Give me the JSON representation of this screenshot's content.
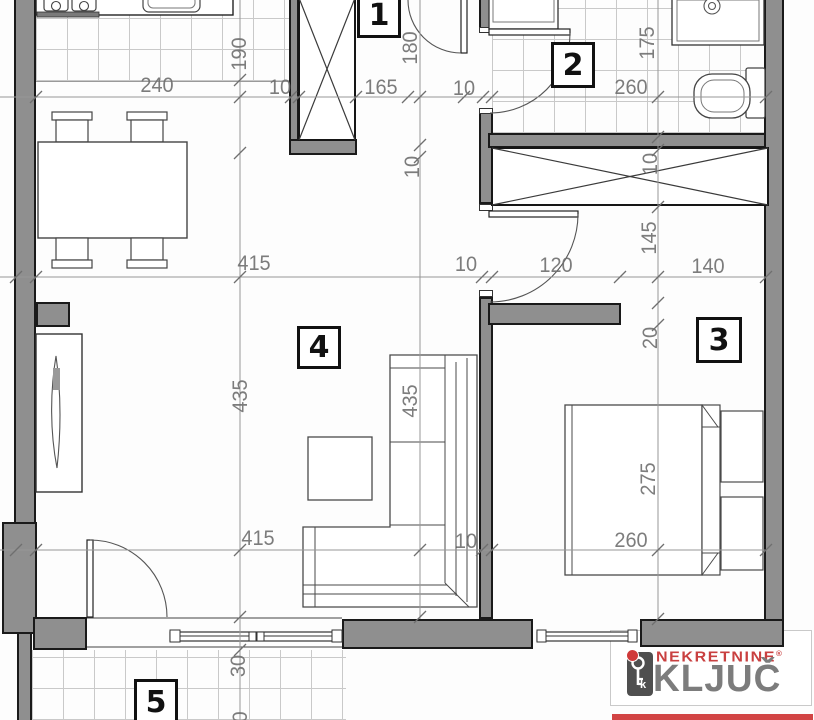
{
  "rooms": {
    "r1": "1",
    "r2": "2",
    "r3": "3",
    "r4": "4",
    "r5": "5"
  },
  "dims": {
    "top": {
      "a": "240",
      "b": "10",
      "c": "165",
      "d": "10",
      "e": "260"
    },
    "mid": {
      "a": "415",
      "b": "10",
      "c": "120",
      "d": "140"
    },
    "bottom": {
      "a": "415",
      "b": "10",
      "c": "260"
    },
    "col_left": {
      "a": "190",
      "b": "435",
      "c": "30",
      "d": "0"
    },
    "col_center": {
      "a": "180",
      "b": "10",
      "c": "435"
    },
    "col_right": {
      "a": "175",
      "b": "10",
      "c": "145",
      "d": "20",
      "e": "275"
    }
  },
  "logo": {
    "nekretnine": "NEKRETNINE",
    "registered_mark": "®",
    "kljuc": "KLJUČ",
    "key_letter": "k"
  },
  "colors": {
    "wall_gray": "#8f8f8f",
    "logo_red": "#c94040",
    "logo_gray": "#7c7c7c"
  }
}
